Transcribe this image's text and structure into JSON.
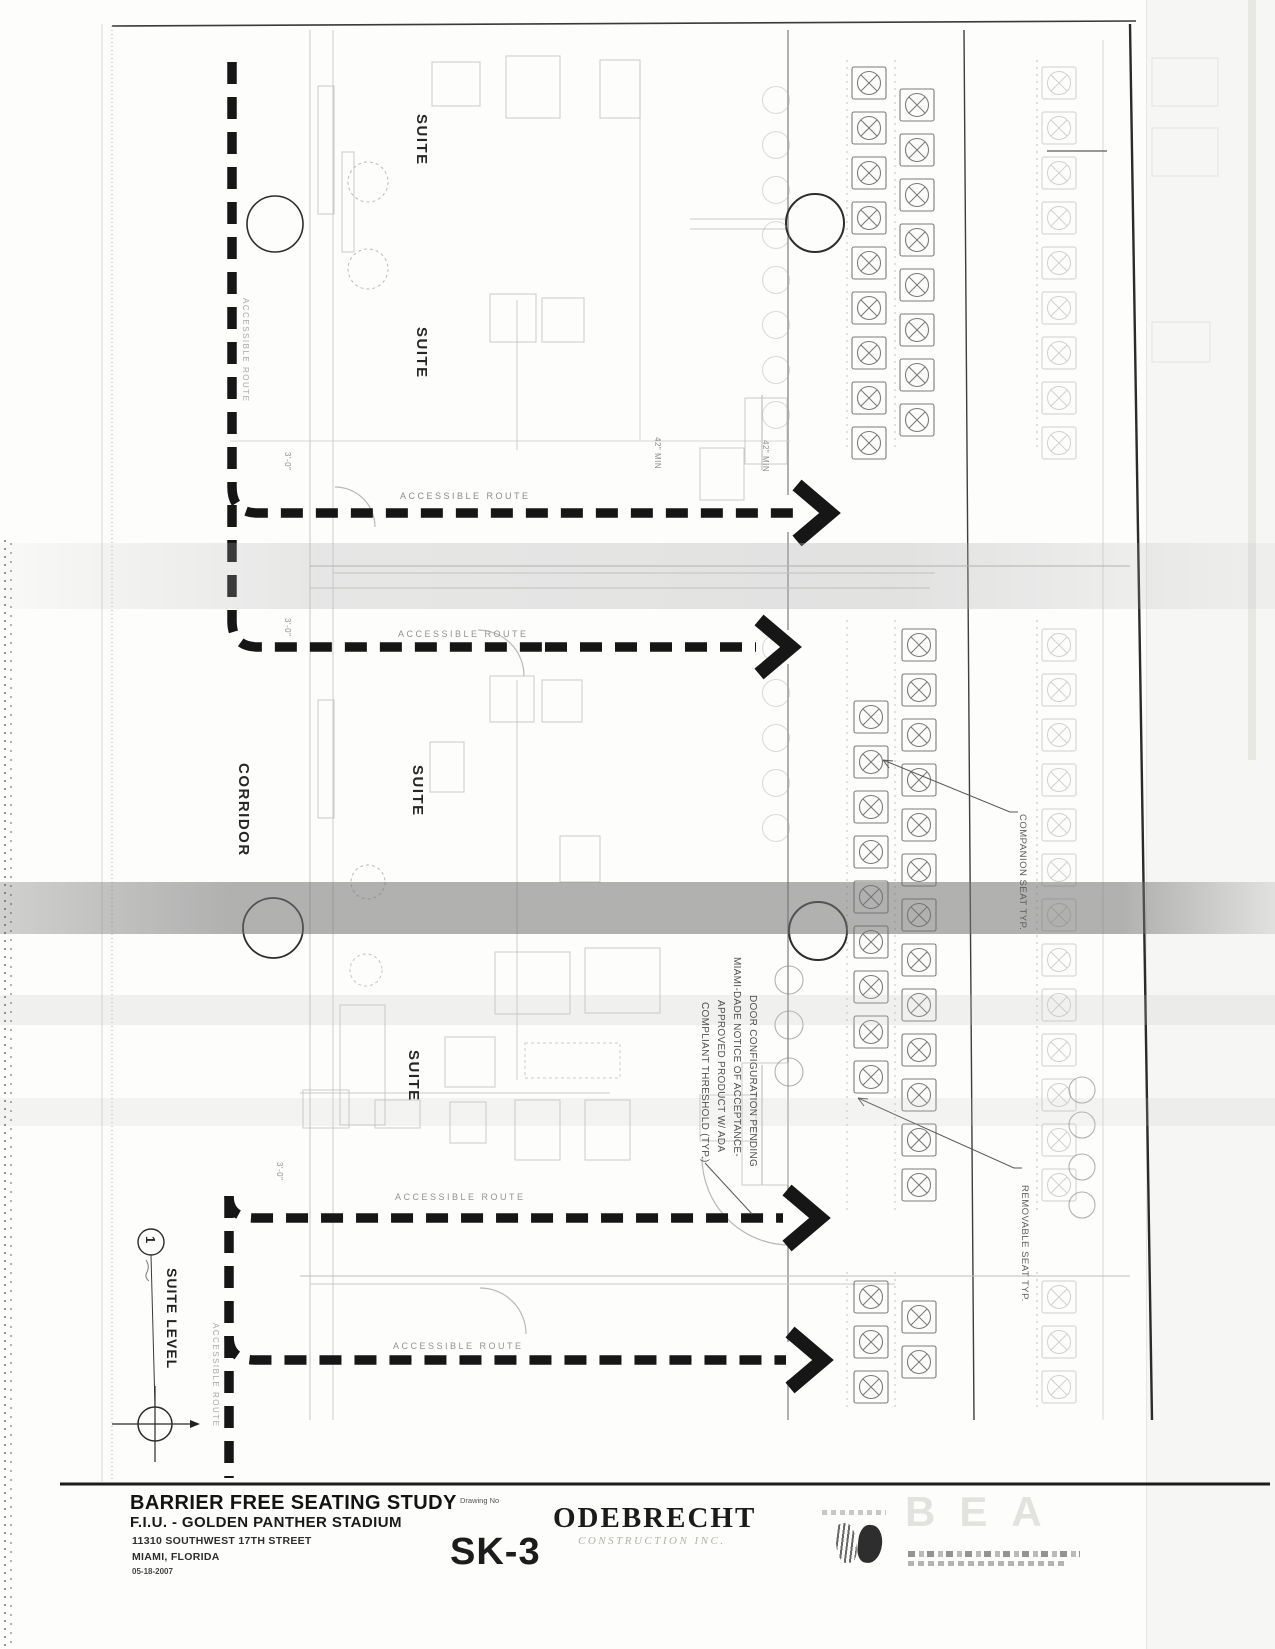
{
  "drawing": {
    "suite_label": "SUITE",
    "corridor_label": "CORRIDOR",
    "accessible_route_label": "ACCESSIBLE ROUTE",
    "companion_seat_note": "COMPANION SEAT TYP.",
    "removable_seat_note": "REMOVABLE SEAT TYP.",
    "door_note": {
      "line1": "DOOR CONFIGURATION PENDING",
      "line2": "MIAMI-DADE NOTICE OF ACCEPTANCE-",
      "line3": "APPROVED PRODUCT W/ ADA",
      "line4": "COMPLIANT THRESHOLD (TYP.)"
    },
    "detail_marker": {
      "number": "1",
      "title": "SUITE LEVEL"
    },
    "dimensions": {
      "clearance": "3'-0\"",
      "min_width": "42\" MIN"
    }
  },
  "title_block": {
    "drawing_title": "BARRIER FREE SEATING STUDY",
    "project_name": "F.I.U. - GOLDEN PANTHER STADIUM",
    "address_line1": "11310 SOUTHWEST 17TH STREET",
    "address_line2": "MIAMI, FLORIDA",
    "date": "05-18-2007",
    "drawing_no_label": "Drawing No",
    "drawing_no": "SK-3",
    "contractor_name": "ODEBRECHT",
    "contractor_subtitle": "CONSTRUCTION INC.",
    "stamp_text": "BEA"
  }
}
